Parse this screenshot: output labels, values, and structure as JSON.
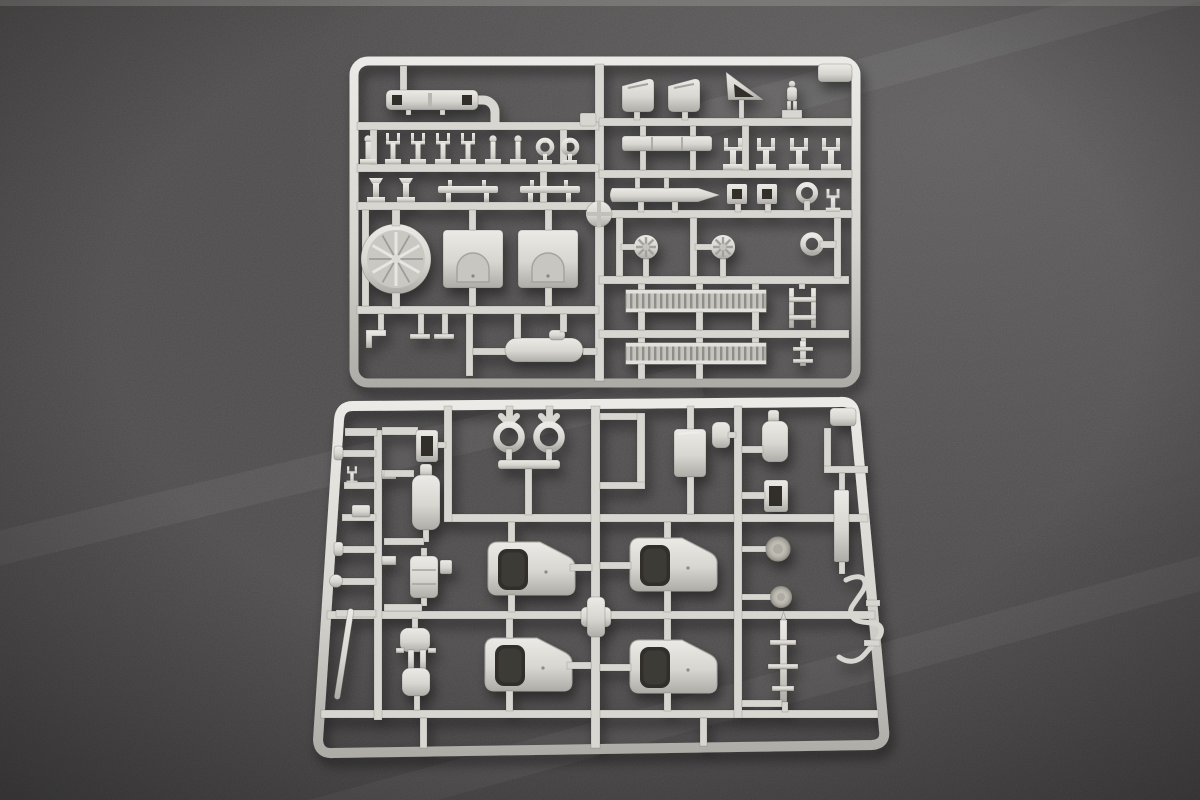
{
  "scene": {
    "type": "photograph",
    "subject": "Two light grey injection-moulded plastic model kit sprues (parts trees) lying on a dark grey cloth surface, photographed from above",
    "colors": {
      "surface": "#4d4b4b",
      "surface_light": "#5c5a59",
      "surface_dark": "#373535",
      "plastic": "#d8d6d0",
      "plastic_highlight": "#eceae6",
      "plastic_shadow": "#aeaca6",
      "cutout_dark": "#312e2b"
    },
    "sprues": [
      {
        "id": "upper",
        "label": "upper sprue",
        "position": "top half of photo, centred",
        "notable_parts": [
          "slotted rail with two dark openings",
          "row of nine railing stanchions (two with ring tops)",
          "two bollards and two spreader bars",
          "circular ventilation fan disc with radial spokes",
          "two rectangular hatch plates with arched doors",
          "two seat backs",
          "signal flag triangle",
          "standing crew figure",
          "long section bar",
          "four davit forks",
          "tapered gun barrel",
          "two square frames with openings",
          "ring eyelet",
          "two valve hand-wheels",
          "towing eye",
          "two ribbed grating strips",
          "ladder section",
          "flanged post"
        ]
      },
      {
        "id": "lower",
        "label": "lower sprue",
        "position": "bottom half of photo, slightly wider, leaning outward",
        "notable_parts": [
          "twin periscope ring assembly",
          "small ladder frame",
          "two bottle-shaped tanks",
          "equipment box",
          "stepped bracket runner",
          "four cab door panels with dark window openings",
          "cross-shaped centre joint",
          "rectangular frame part",
          "two round textured caps",
          "axle shaft with collars",
          "tall flat bar",
          "bent grab-rail wire",
          "clamp bracket with two pads",
          "thin diagonal rod",
          "row of small studs and pins along left edge"
        ]
      }
    ]
  }
}
